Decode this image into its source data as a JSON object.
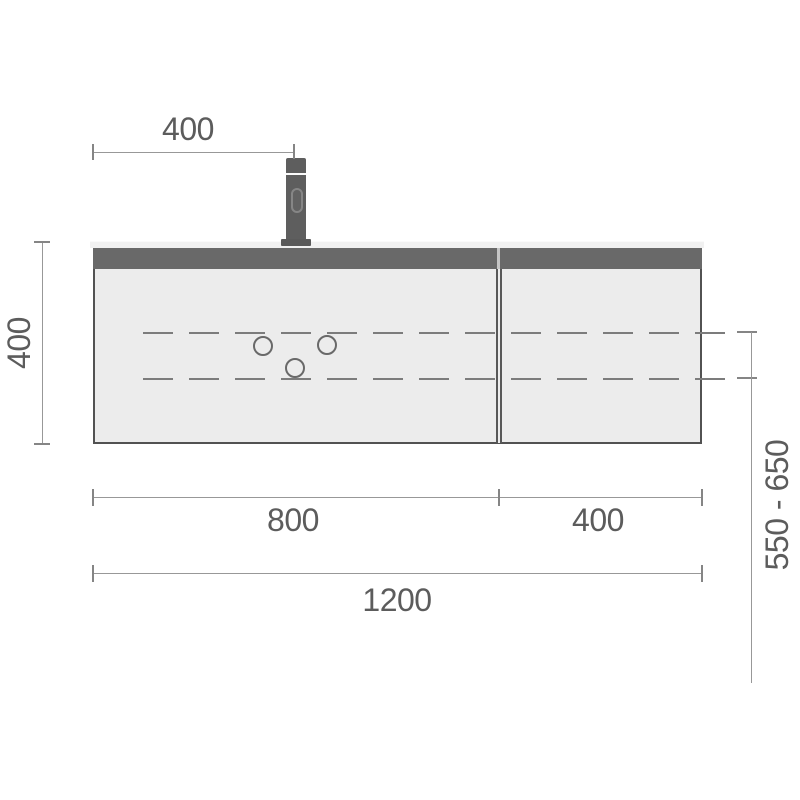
{
  "drawing": {
    "type": "vanity-unit-front-elevation-technical-drawing",
    "dimensions": {
      "faucet_offset": "400",
      "cabinet_height": "400",
      "left_section_width": "800",
      "right_section_width": "400",
      "total_width": "1200",
      "mounting_height_range": "550 - 650"
    },
    "colors": {
      "background": "#ffffff",
      "cabinet_body": "#ececec",
      "top_band": "#696969",
      "countertop": "#f1f1f1",
      "faucet": "#5e5e5e",
      "dimension_lines": "#989898",
      "dashed_lines": "#7c7c7c",
      "label_text": "#5c5c5c"
    },
    "icons": {
      "faucet": "faucet-icon",
      "drill_hole": "circle-outline"
    }
  }
}
